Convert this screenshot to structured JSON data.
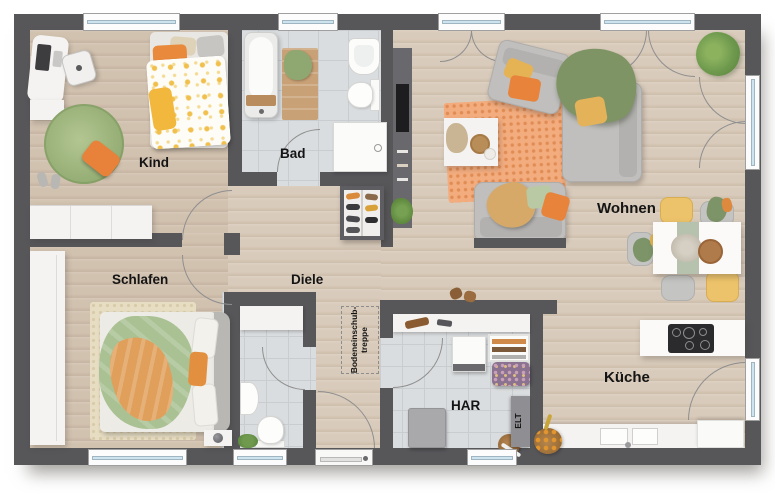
{
  "plan": {
    "rooms": {
      "kind": {
        "label": "Kind"
      },
      "bad": {
        "label": "Bad"
      },
      "wohnen": {
        "label": "Wohnen"
      },
      "schlafen": {
        "label": "Schlafen"
      },
      "diele": {
        "label": "Diele"
      },
      "kueche": {
        "label": "Küche"
      },
      "har": {
        "label": "HAR"
      },
      "elt": {
        "label": "ELT"
      }
    },
    "annotations": {
      "treppe_line1": "Bodeneinschub-",
      "treppe_line2": "treppe"
    },
    "colors": {
      "wall": "#57575a",
      "wood_floor": "#d9cbbb",
      "tile_floor": "#dadddf",
      "accent_orange": "#e8833c",
      "accent_green": "#a9c193",
      "accent_yellow": "#ecc36a"
    }
  }
}
